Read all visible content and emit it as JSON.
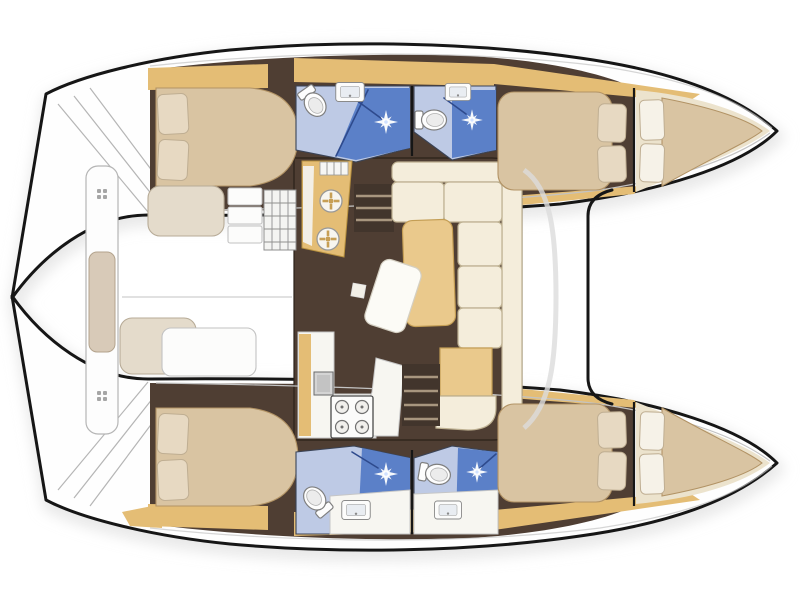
{
  "diagram": {
    "type": "floor-plan",
    "subject": "catamaran-yacht-interior-top-view",
    "orientation": {
      "bow": "right",
      "stern": "left"
    },
    "regions": [
      "cockpit",
      "cockpit-bench",
      "port-transom-steps",
      "starboard-transom-steps",
      "salon",
      "galley",
      "dinette",
      "foredeck-trampoline",
      "port-aft-cabin",
      "port-aft-head",
      "port-forward-head",
      "port-forward-cabin",
      "port-forepeak",
      "starboard-aft-cabin",
      "starboard-aft-head",
      "starboard-forward-head",
      "starboard-forward-cabin",
      "starboard-forepeak"
    ],
    "fixtures": [
      "double-berth",
      "pillow",
      "toilet",
      "shower",
      "sink",
      "round-galley-sink",
      "stove-4-burner",
      "companionway-steps",
      "dinette-sofa",
      "dinette-table",
      "coffee-table",
      "shelves",
      "hatch-grid",
      "bench-cushion",
      "cleat",
      "mast-crossbeam"
    ]
  },
  "colors": {
    "background": "#ffffff",
    "outline": "#161616",
    "hullWhite": "#fefefe",
    "shadow": "#dcdcdc",
    "floorDark": "#4f3e33",
    "wood": "#e4bd75",
    "woodEdge": "#b8913f",
    "woodDark": "#c79f55",
    "cushion": "#d9c4a2",
    "cushionEdge": "#b29365",
    "pillow": "#e7d9c2",
    "pillowEdge": "#bfae92",
    "sofa": "#f4eddb",
    "sofaEdge": "#bdb091",
    "tableTan": "#eac98c",
    "tableEdge": "#c49e55",
    "bathFloor": "#becae5",
    "showerBlue": "#5b80c8",
    "showerDeep": "#2e4a8d",
    "fixtureWhite": "#fcfcfb",
    "fixtureEdge": "#c2c2c2",
    "counterWhite": "#f7f6f1",
    "counterEdge": "#c6c6c6",
    "ottoman": "#e4dbcb",
    "ottomanEdge": "#b7ab97",
    "grayLine": "#c3c3c3",
    "stepLine": "#a8967f",
    "creamDeck": "#ece3cd",
    "gridLine": "#8f8f8f",
    "sparkleWhite": "#ffffff"
  }
}
